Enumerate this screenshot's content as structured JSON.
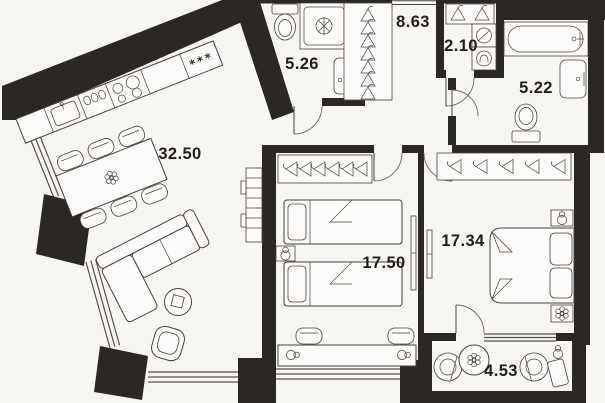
{
  "meta": {
    "title": "Apartment floor plan",
    "canvas_width": 605,
    "canvas_height": 403
  },
  "colors": {
    "background": "#f7f6f3",
    "wall": "#2b2724",
    "furniture_stroke": "#45413d",
    "label_text": "#201d1a"
  },
  "rooms": [
    {
      "id": "living-room-kitchen",
      "area_label": "32.50"
    },
    {
      "id": "shower-bathroom",
      "area_label": "5.26"
    },
    {
      "id": "hallway",
      "area_label": "8.63"
    },
    {
      "id": "laundry-closet",
      "area_label": "2.10"
    },
    {
      "id": "main-bathroom",
      "area_label": "5.22"
    },
    {
      "id": "bedroom-left",
      "area_label": "17.50"
    },
    {
      "id": "bedroom-right",
      "area_label": "17.34"
    },
    {
      "id": "balcony",
      "area_label": "4.53"
    }
  ],
  "kitchen": {
    "unit_label": "***"
  },
  "icons": [
    "kitchen-sink-icon",
    "stove-burners-icon",
    "freezer-stars-label",
    "dining-table",
    "dining-chair",
    "flower-icon",
    "sofa",
    "coffee-table",
    "armchair",
    "storage-rack",
    "radiator",
    "toilet-icon",
    "shower-cabin-icon",
    "washbasin-icon",
    "bathtub-icon",
    "washer-icon",
    "dryer-icon",
    "hanger-icon",
    "wardrobe",
    "single-bed",
    "double-bed",
    "pillow",
    "nightstand",
    "lamp-icon",
    "desk",
    "desk-chair",
    "balcony-armchair",
    "plant-table",
    "side-table",
    "entry-door",
    "door-arc",
    "window"
  ]
}
